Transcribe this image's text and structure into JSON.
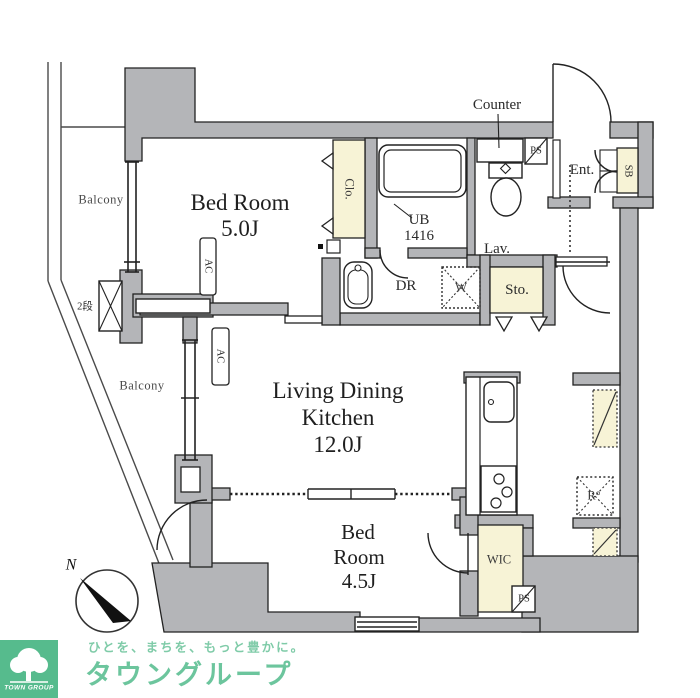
{
  "plan": {
    "labels": {
      "counter": "Counter",
      "ps_top": "PS",
      "ent": "Ent.",
      "sb": "SB",
      "clo": "Clo.",
      "ub_line1": "UB",
      "ub_line2": "1416",
      "lav": "Lav.",
      "dr": "DR",
      "washer": "W",
      "sto": "Sto.",
      "bedroom1_line1": "Bed Room",
      "bedroom1_size": "5.0J",
      "balcony_upper": "Balcony",
      "balcony_lower": "Balcony",
      "two_step": "2段",
      "ac1": "AC",
      "ac2": "AC",
      "ldk_line1": "Living Dining",
      "ldk_line2": "Kitchen",
      "ldk_size": "12.0J",
      "fridge": "R°",
      "bedroom2_line1": "Bed",
      "bedroom2_line2": "Room",
      "bedroom2_size": "4.5J",
      "wic": "WIC",
      "ps_bottom": "PS",
      "compass_north": "N"
    },
    "colors": {
      "wall": "#b4b5b8",
      "accent_cream": "#f7f3d6",
      "line": "#222222",
      "logo_green": "#56bb8d",
      "brand_green": "#6cc59d",
      "tagline_green": "#7fcba8"
    }
  },
  "footer": {
    "logo_caption": "TOWN GROUP",
    "tagline": "ひとを、まちを、もっと豊かに。",
    "brand": "タウングループ"
  }
}
